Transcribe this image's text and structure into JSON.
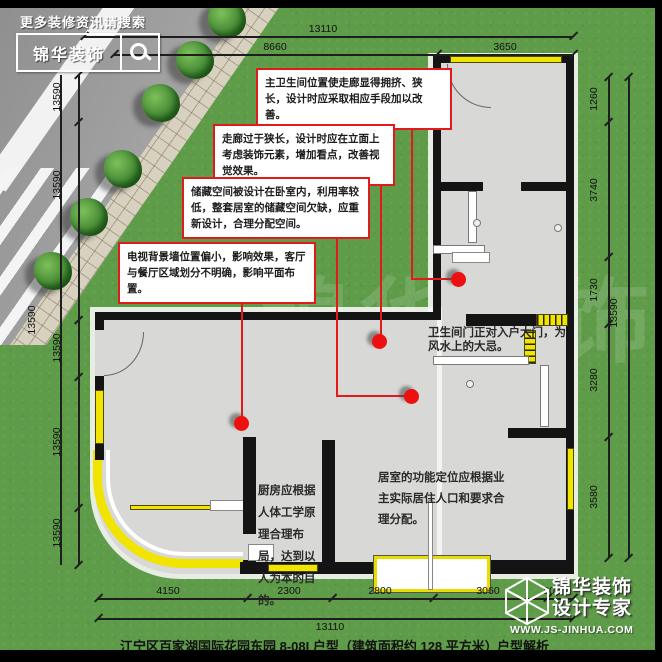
{
  "header": {
    "search_hint": "更多装修资讯请搜索",
    "logo_text": "锦华装饰"
  },
  "callouts": [
    {
      "text": "主卫生间位置使走廊显得拥挤、狭长，设计时应采取相应手段加以改善。"
    },
    {
      "text": "走廊过于狭长，设计时应在立面上考虑装饰元素，增加看点，改善视觉效果。"
    },
    {
      "text": "储藏空间被设计在卧室内，利用率较低，整套居室的储藏空间欠缺，应重新设计，合理分配空间。"
    },
    {
      "text": "电视背景墙位置偏小，影响效果，客厅与餐厅区域划分不明确，影响平面布置。"
    }
  ],
  "plan_notes": [
    {
      "text": "卫生间门正对入户大门，为风水上的大忌。"
    },
    {
      "text": "厨房应根据人体工学原理合理布局，达到以人为本的目的。"
    },
    {
      "text": "居室的功能定位应根据业主实际居住人口和要求合理分配。"
    }
  ],
  "dimensions": {
    "top": {
      "total": "13110",
      "segments": [
        "8660",
        "3650"
      ]
    },
    "bottom": {
      "total": "13110",
      "segments": [
        "4150",
        "2300",
        "2800",
        "3060",
        "800"
      ]
    },
    "left": {
      "total": "13590",
      "segments": [
        "13590",
        "13590",
        "13590",
        "13590",
        "13590"
      ]
    },
    "right": {
      "total": "13590",
      "segments": [
        "1260",
        "3740",
        "1730",
        "3280",
        "3580"
      ]
    }
  },
  "footer": {
    "caption": "江宁区百家湖国际花园东园 8-08I 户型（建筑面积约 128 平方米）",
    "section_label": "户型解析"
  },
  "brand": {
    "name": "锦华装饰",
    "tagline": "设计专家",
    "website": "WWW.JS-JINHUA.COM"
  },
  "watermark": "锦华装饰",
  "colors": {
    "grass": "#5f9c49",
    "road": "#9b9b9b",
    "floor": "#d8d8d6",
    "wall": "#141414",
    "window_yellow": "#f0e400",
    "callout_red": "#e01b1b"
  }
}
